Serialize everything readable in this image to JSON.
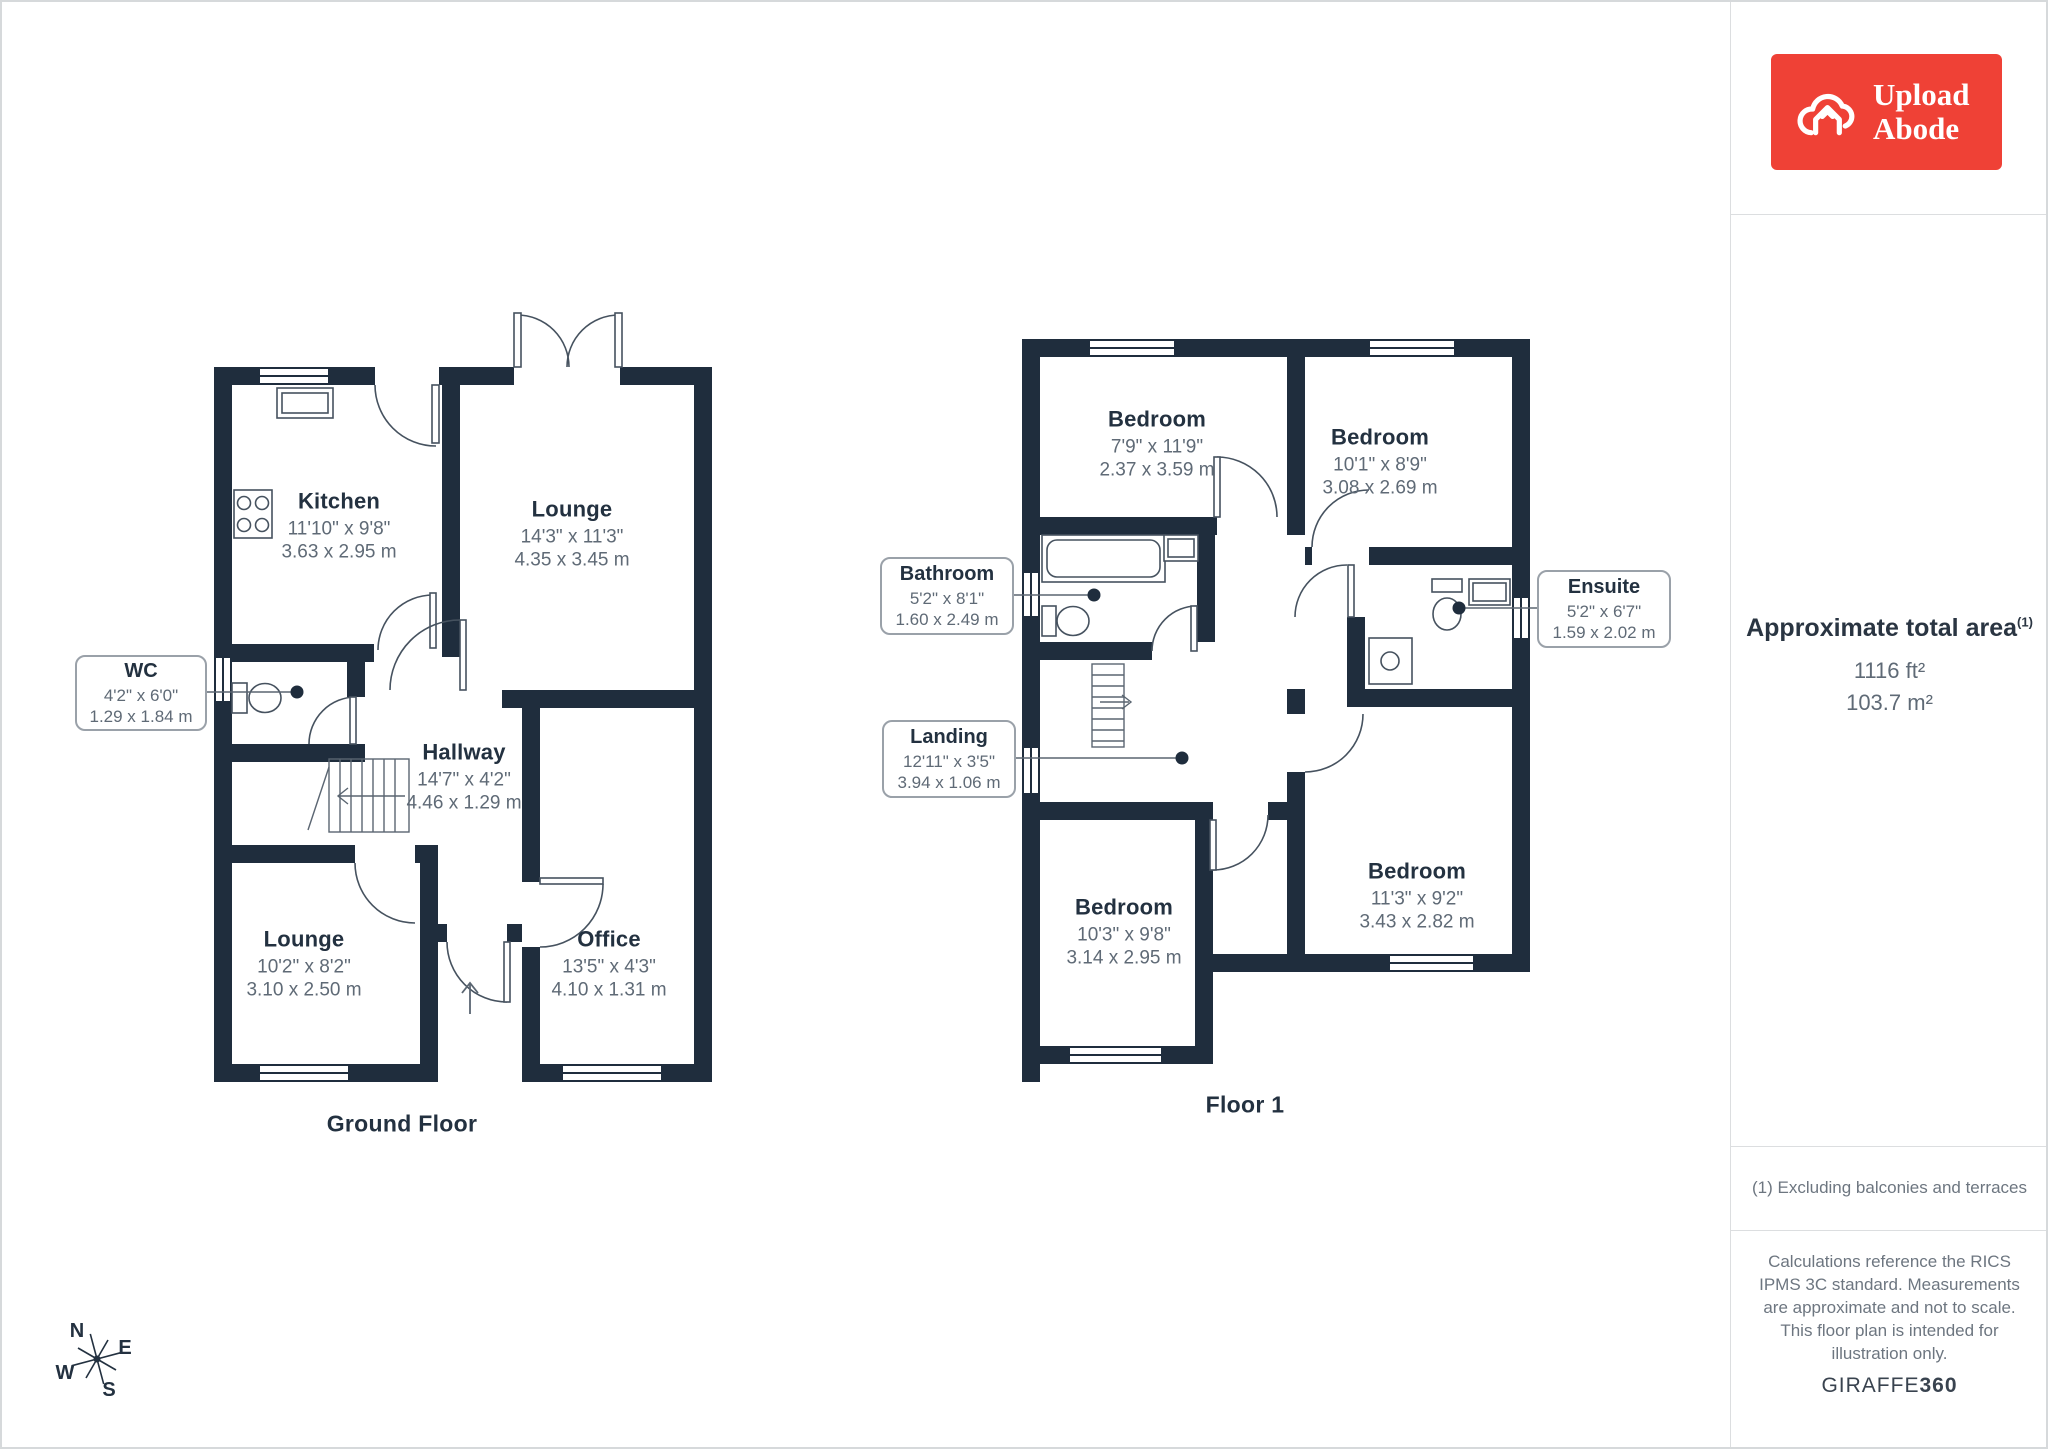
{
  "branding": {
    "logo_line1": "Upload",
    "logo_line2": "Abode",
    "logo_color": "#ef4136",
    "footer_brand": "GIRAFFE",
    "footer_brand_bold": "360"
  },
  "sidebar": {
    "area_title": "Approximate total area",
    "area_marker": "(1)",
    "area_imperial": "1116 ft²",
    "area_metric": "103.7 m²",
    "footnote": "(1) Excluding balconies and terraces",
    "disclaimer": "Calculations reference the RICS IPMS 3C standard. Measurements are approximate and not to scale. This floor plan is intended for illustration only."
  },
  "ground_floor": {
    "label": "Ground Floor",
    "rooms": {
      "kitchen": {
        "name": "Kitchen",
        "imperial": "11'10\" x 9'8\"",
        "metric": "3.63 x 2.95 m"
      },
      "lounge": {
        "name": "Lounge",
        "imperial": "14'3\" x 11'3\"",
        "metric": "4.35 x 3.45 m"
      },
      "hallway": {
        "name": "Hallway",
        "imperial": "14'7\" x 4'2\"",
        "metric": "4.46 x 1.29 m"
      },
      "lounge2": {
        "name": "Lounge",
        "imperial": "10'2\" x 8'2\"",
        "metric": "3.10 x 2.50 m"
      },
      "office": {
        "name": "Office",
        "imperial": "13'5\" x 4'3\"",
        "metric": "4.10 x 1.31 m"
      },
      "wc": {
        "name": "WC",
        "imperial": "4'2\" x 6'0\"",
        "metric": "1.29 x 1.84 m"
      }
    }
  },
  "floor_1": {
    "label": "Floor 1",
    "rooms": {
      "bedroom_tl": {
        "name": "Bedroom",
        "imperial": "7'9\" x 11'9\"",
        "metric": "2.37 x 3.59 m"
      },
      "bedroom_tr": {
        "name": "Bedroom",
        "imperial": "10'1\" x 8'9\"",
        "metric": "3.08 x 2.69 m"
      },
      "bedroom_bl": {
        "name": "Bedroom",
        "imperial": "10'3\" x 9'8\"",
        "metric": "3.14 x 2.95 m"
      },
      "bedroom_br": {
        "name": "Bedroom",
        "imperial": "11'3\" x 9'2\"",
        "metric": "3.43 x 2.82 m"
      },
      "bathroom": {
        "name": "Bathroom",
        "imperial": "5'2\" x 8'1\"",
        "metric": "1.60 x 2.49 m"
      },
      "landing": {
        "name": "Landing",
        "imperial": "12'11\" x 3'5\"",
        "metric": "3.94 x 1.06 m"
      },
      "ensuite": {
        "name": "Ensuite",
        "imperial": "5'2\" x 6'7\"",
        "metric": "1.59 x 2.02 m"
      }
    }
  },
  "compass": {
    "n": "N",
    "e": "E",
    "s": "S",
    "w": "W"
  },
  "colors": {
    "wall": "#1f2d3d",
    "dim_text": "#5f6a76",
    "logo_red": "#ef4136"
  }
}
